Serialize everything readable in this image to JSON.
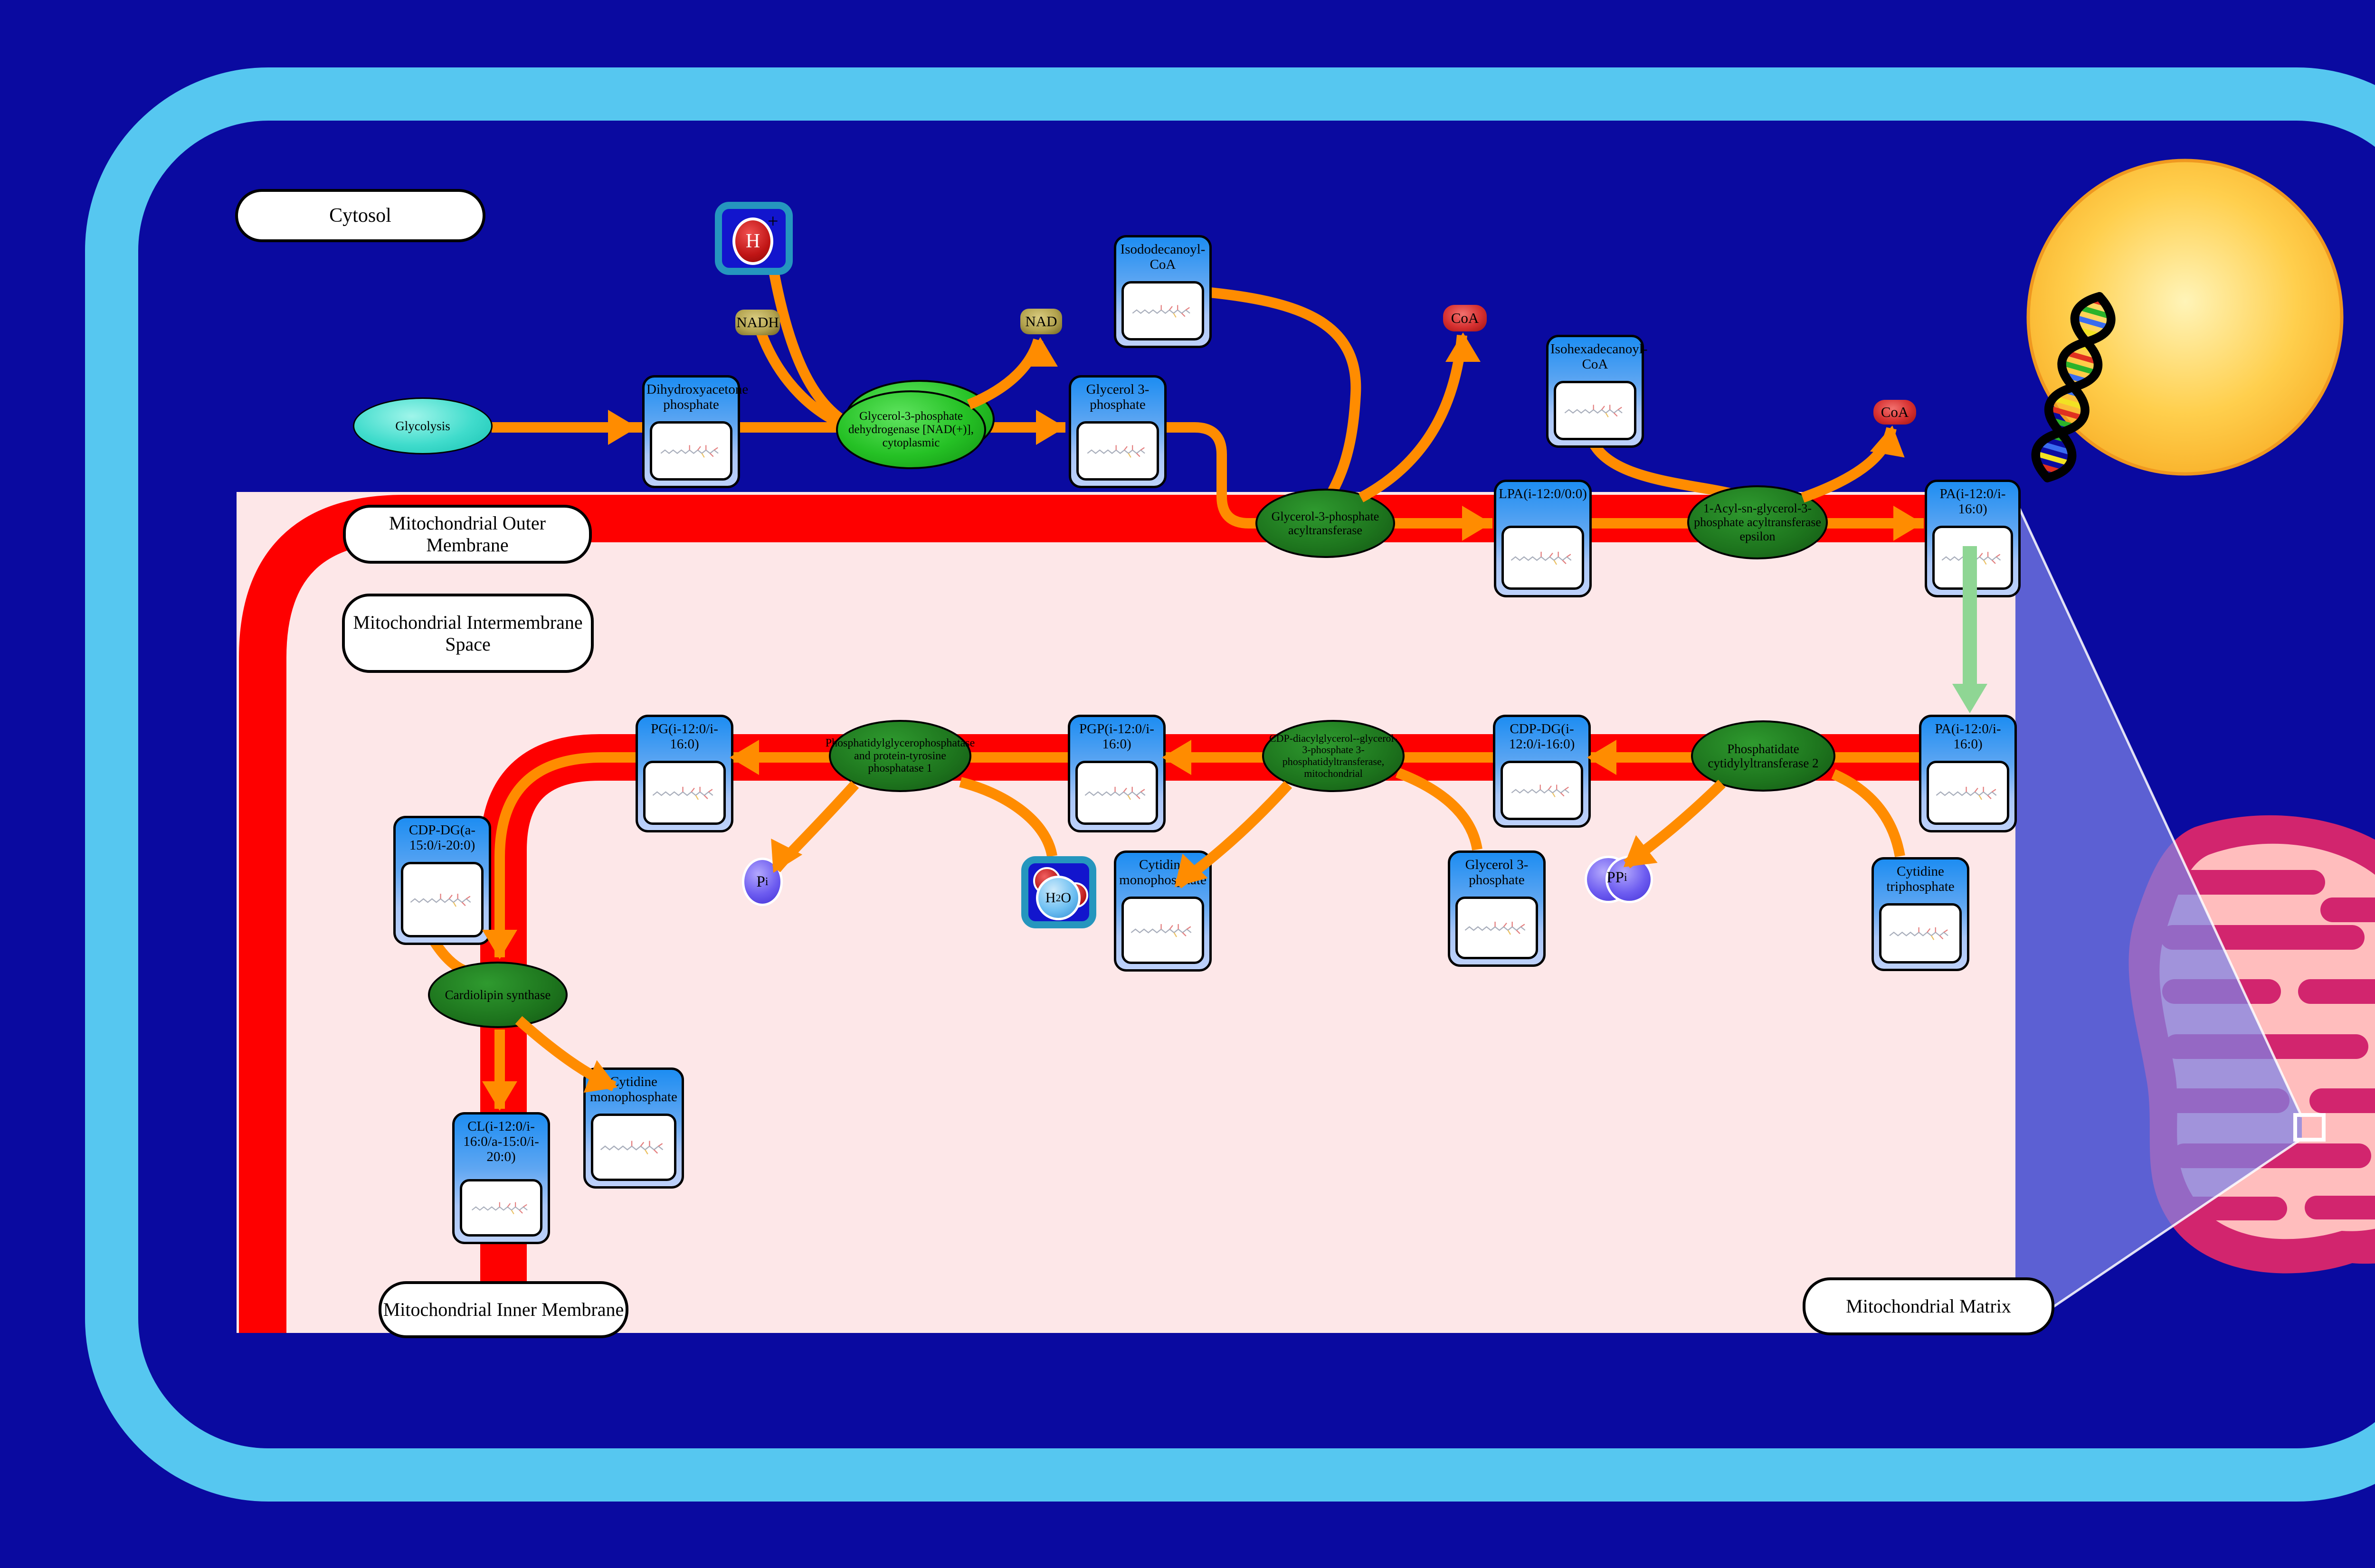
{
  "labels": {
    "cytosol": "Cytosol",
    "outer_membrane": "Mitochondrial Outer Membrane",
    "intermembrane_space": "Mitochondrial Intermembrane Space",
    "inner_membrane": "Mitochondrial Inner Membrane",
    "matrix": "Mitochondrial Matrix"
  },
  "pathway_node": {
    "label": "Glycolysis"
  },
  "enzymes": [
    {
      "id": "gpdh",
      "label": "Glycerol-3-phosphate dehydrogenase [NAD(+)], cytoplasmic"
    },
    {
      "id": "gpat",
      "label": "Glycerol-3-phosphate acyltransferase"
    },
    {
      "id": "agpat",
      "label": "1-Acyl-sn-glycerol-3-phosphate acyltransferase epsilon"
    },
    {
      "id": "pcyt2",
      "label": "Phosphatidate cytidylyltransferase 2"
    },
    {
      "id": "cds",
      "label": "CDP-diacylglycerol--glycerol-3-phosphate 3-phosphatidyltransferase, mitochondrial"
    },
    {
      "id": "ptpmt",
      "label": "Phosphatidylglycerophosphatase and protein-tyrosine phosphatase 1"
    },
    {
      "id": "cls",
      "label": "Cardiolipin synthase"
    }
  ],
  "metabolites": [
    {
      "id": "dhap",
      "label": "Dihydroxyacetone phosphate"
    },
    {
      "id": "g3p_top",
      "label": "Glycerol 3-phosphate"
    },
    {
      "id": "iso12",
      "label": "Isododecanoyl-CoA"
    },
    {
      "id": "iso16",
      "label": "Isohexadecanoyl-CoA"
    },
    {
      "id": "lpa",
      "label": "LPA(i-12:0/0:0)"
    },
    {
      "id": "pa_top",
      "label": "PA(i-12:0/i-16:0)"
    },
    {
      "id": "pa_mid",
      "label": "PA(i-12:0/i-16:0)"
    },
    {
      "id": "ctp",
      "label": "Cytidine triphosphate"
    },
    {
      "id": "cdpdg_mid",
      "label": "CDP-DG(i-12:0/i-16:0)"
    },
    {
      "id": "g3p_low",
      "label": "Glycerol 3-phosphate"
    },
    {
      "id": "pgp",
      "label": "PGP(i-12:0/i-16:0)"
    },
    {
      "id": "cmp_mid",
      "label": "Cytidine monophosphate"
    },
    {
      "id": "pg",
      "label": "PG(i-12:0/i-16:0)"
    },
    {
      "id": "cdpdg_low",
      "label": "CDP-DG(a-15:0/i-20:0)"
    },
    {
      "id": "cmp_low",
      "label": "Cytidine monophosphate"
    },
    {
      "id": "cl",
      "label": "CL(i-12:0/i-16:0/a-15:0/i-20:0)"
    }
  ],
  "badges": [
    {
      "id": "nadh",
      "label": "NADH"
    },
    {
      "id": "nad",
      "label": "NAD"
    },
    {
      "id": "coa1",
      "label": "CoA"
    },
    {
      "id": "coa2",
      "label": "CoA"
    },
    {
      "id": "ppi",
      "label": "PP",
      "sub": "i"
    },
    {
      "id": "pi",
      "label": "P",
      "sub": "i"
    }
  ],
  "icons": [
    {
      "id": "hplus",
      "label": "H",
      "sup": "+"
    },
    {
      "id": "h2o",
      "pre": "H",
      "sub": "2",
      "post": "O"
    }
  ],
  "colors": {
    "background": "#0a0aa0",
    "cell_border": "#56c7f0",
    "membrane_red": "#fe0000",
    "matrix_pink": "#fde7e8",
    "arrow_orange": "#ff8c00",
    "transport_green": "#8fd694",
    "node_header_blue": "#1d8df2",
    "enzyme_green": "#1d741d",
    "nucleus_gold": "#ffc933",
    "mitochondrion_crimson": "#d2256e",
    "lens_purple": "#7d82e6"
  }
}
